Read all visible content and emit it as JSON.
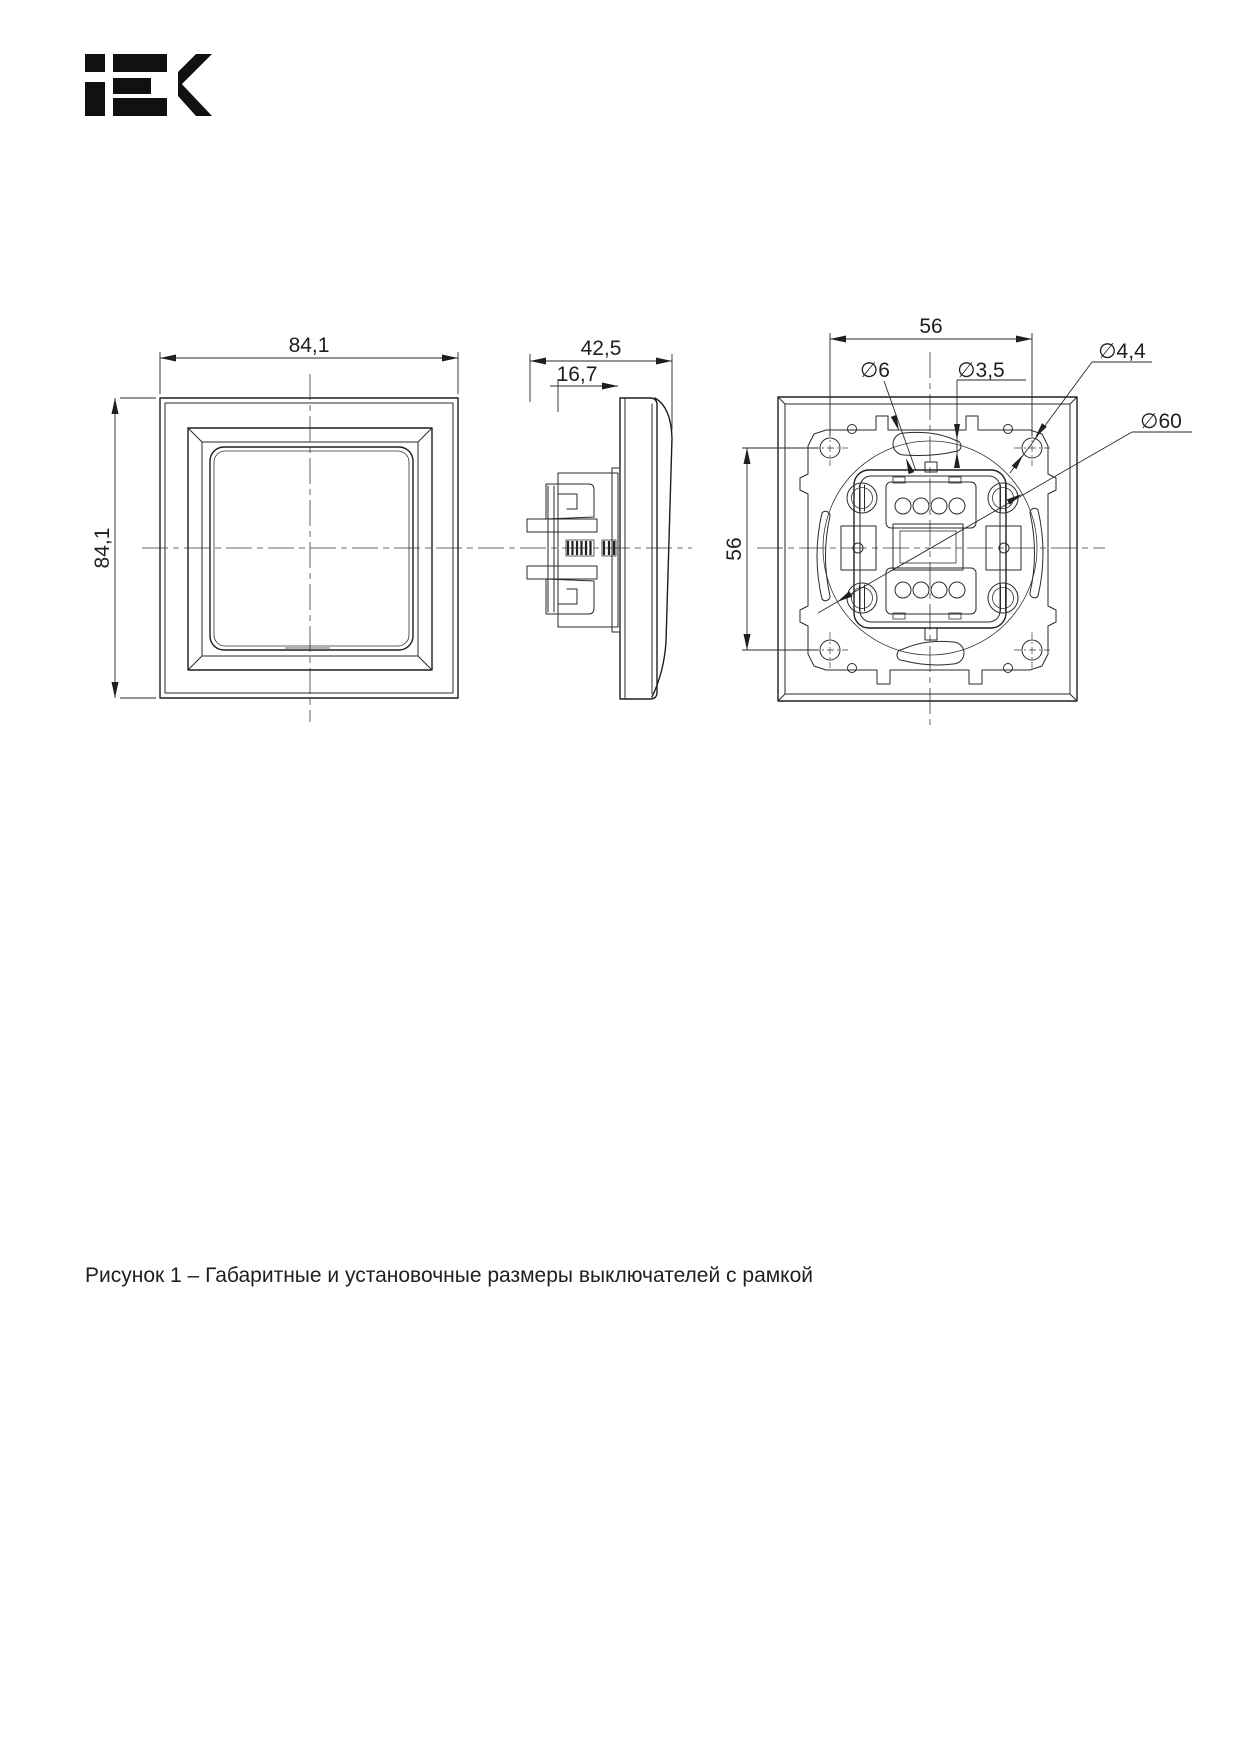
{
  "logo": {
    "name": "IEK"
  },
  "caption": "Рисунок 1 – Габаритные и установочные размеры выключателей с рамкой",
  "dimensions": {
    "front_width": "84,1",
    "front_height": "84,1",
    "side_depth": "42,5",
    "side_mech_depth": "16,7",
    "rear_spacing_top": "56",
    "rear_spacing_left": "56",
    "dia_slot_wide": "∅6",
    "dia_slot_narrow": "∅3,5",
    "dia_frame_hole": "∅4,4",
    "dia_mount_circle": "∅60"
  },
  "colors": {
    "line": "#1f1f1f",
    "background": "#ffffff"
  }
}
